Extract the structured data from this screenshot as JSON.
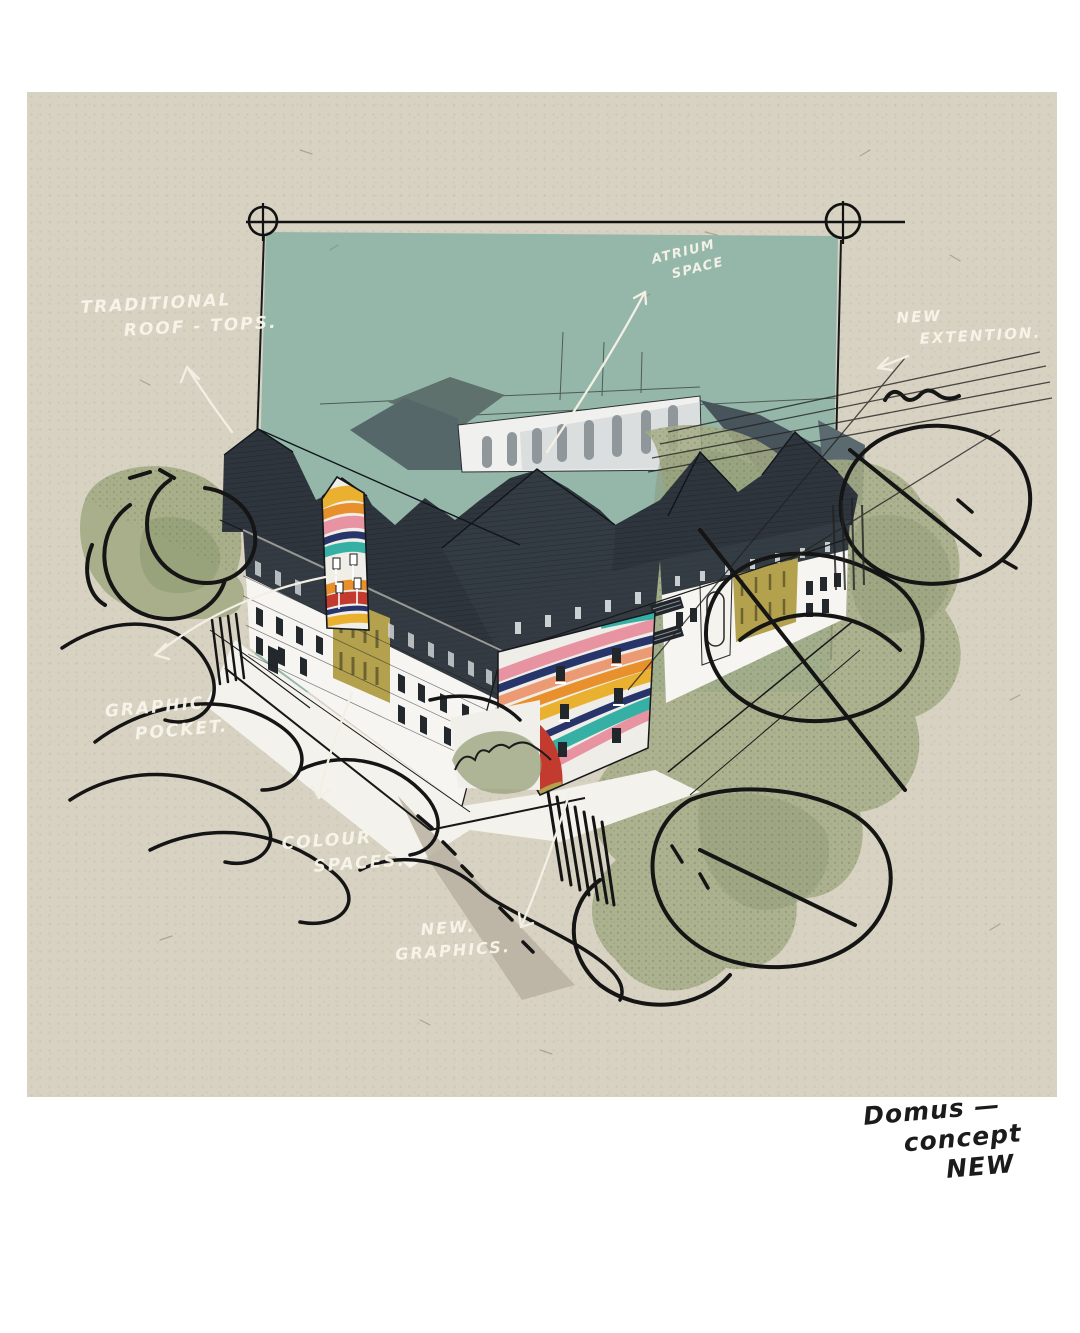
{
  "artwork": {
    "annotations": {
      "traditional_rooftops": {
        "line1": "TRADITIONAL",
        "line2": "ROOF - TOPS."
      },
      "atrium_space": {
        "line1": "ATRIUM",
        "line2": "SPACE"
      },
      "new_extension": {
        "line1": "NEW",
        "line2": "EXTENTION."
      },
      "graphic_pocket": {
        "line1": "GRAPHIC",
        "line2": "POCKET."
      },
      "colour_spaces": {
        "line1": "COLOUR",
        "line2": "SPACES."
      },
      "new_graphics": {
        "line1": "NEW.",
        "line2": "GRAPHICS."
      }
    },
    "signature": {
      "line1": "Domus —",
      "line2": "concept",
      "line3": "NEW"
    },
    "palette": {
      "paper": "#d8d2c2",
      "backdrop_teal": "#95b7aa",
      "roof_charcoal": "#2e353c",
      "facade_white": "#f6f5f1",
      "facade_gold": "#b3a14e",
      "greenery": "#a4ab86",
      "ink_black": "#181818",
      "ink_white": "#f2efe4",
      "mural_red": "#c23b2e",
      "mural_orange": "#e8912c",
      "mural_yellow": "#eab02f",
      "mural_pink": "#e893a2",
      "mural_teal": "#36b0a4",
      "mural_navy": "#27356b"
    }
  }
}
